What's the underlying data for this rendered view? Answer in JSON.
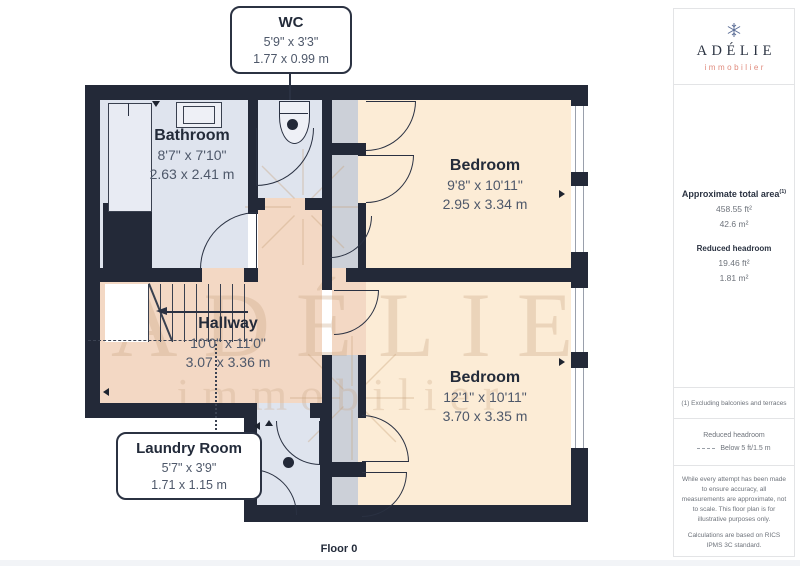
{
  "plan": {
    "floor_label": "Floor 0",
    "watermark": {
      "brand": "ADÉLIE",
      "tagline": "immobilier"
    },
    "rooms": {
      "wc": {
        "name": "WC",
        "imperial": "5'9\" x 3'3\"",
        "metric": "1.77 x 0.99 m"
      },
      "bathroom": {
        "name": "Bathroom",
        "imperial": "8'7\" x 7'10\"",
        "metric": "2.63 x 2.41 m"
      },
      "bedroom_top": {
        "name": "Bedroom",
        "imperial": "9'8\" x 10'11\"",
        "metric": "2.95 x 3.34 m"
      },
      "hallway": {
        "name": "Hallway",
        "imperial": "10'0\" x 11'0\"",
        "metric": "3.07 x 3.36 m"
      },
      "bedroom_bottom": {
        "name": "Bedroom",
        "imperial": "12'1\" x 10'11\"",
        "metric": "3.70 x 3.35 m"
      },
      "laundry": {
        "name": "Laundry Room",
        "imperial": "5'7\" x 3'9\"",
        "metric": "1.71 x 1.15 m"
      }
    }
  },
  "sidebar": {
    "logo": {
      "brand": "ADÉLIE",
      "tagline": "immobilier"
    },
    "area": {
      "title": "Approximate total area",
      "footnote_marker": "(1)",
      "imperial": "458.55 ft²",
      "metric": "42.6 m²",
      "reduced_title": "Reduced headroom",
      "reduced_imperial": "19.46 ft²",
      "reduced_metric": "1.81 m²"
    },
    "footnote": "(1) Excluding balconies and terraces",
    "legend": {
      "title": "Reduced headroom",
      "label": "Below 5 ft/1.5 m"
    },
    "disclaimer": "While every attempt has been made to ensure accuracy, all measurements are approximate, not to scale. This floor plan is for illustrative purposes only.",
    "standard": "Calculations are based on RICS IPMS 3C standard.",
    "credit": {
      "brand": "GIRAFFE",
      "suffix": "360"
    }
  },
  "colors": {
    "wall": "#232938",
    "floor_warm": "#fcecd6",
    "floor_warm_dark": "#f3d8c4",
    "floor_cool": "#dfe4ee",
    "closet_gray": "#ccd0d8",
    "brand_navy": "#2b3342",
    "brand_salmon": "#e08a7c",
    "watermark_tan": "#cda783"
  }
}
